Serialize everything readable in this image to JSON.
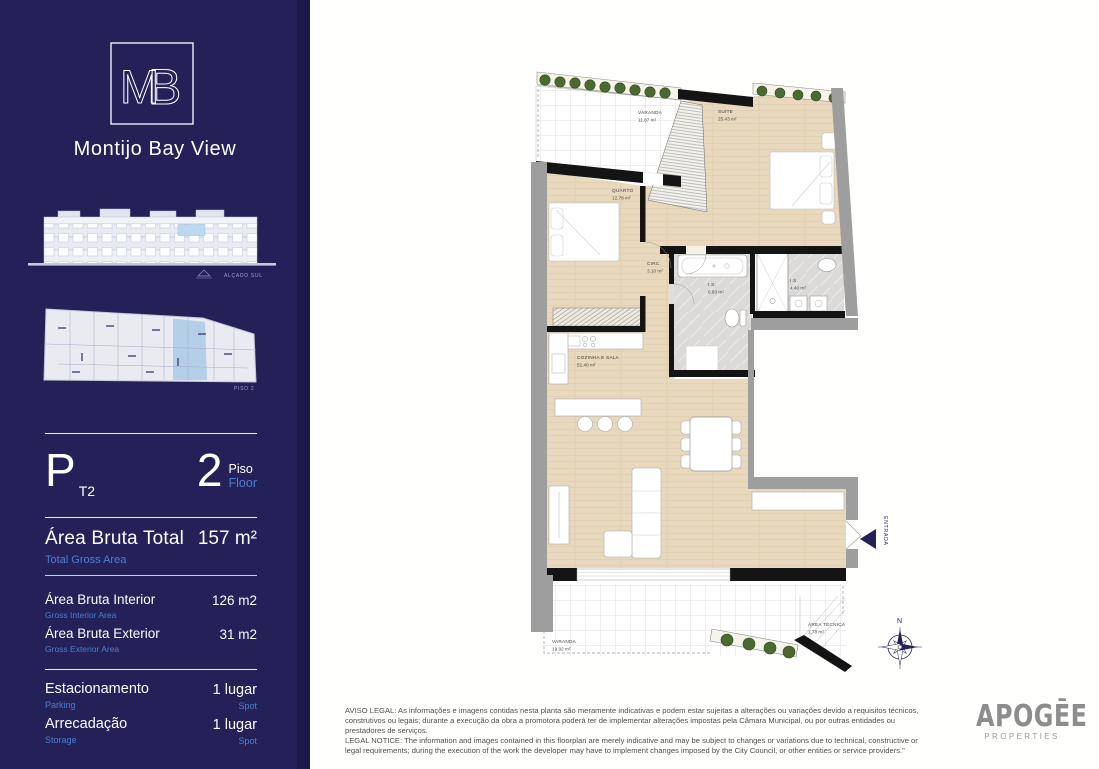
{
  "theme": {
    "navy": "#232158",
    "accent_blue": "#4d7fd2",
    "wall_gray": "#9e9e9e",
    "wood": "#e8d8bd",
    "highlight_blue": "#b5cfe9",
    "plant_green": "#4b6a2f"
  },
  "sidebar": {
    "logo": {
      "m": "M",
      "b": "B"
    },
    "project_name": "Montijo Bay View",
    "elevation_caption": "ALÇADO SUL",
    "keyplan_caption": "PISO 2",
    "unit": {
      "type_letter": "P",
      "typology": "T2",
      "floor_number": "2",
      "floor_label_pt": "Piso",
      "floor_label_en": "Floor"
    },
    "areas": {
      "total": {
        "label_pt": "Área Bruta Total",
        "label_en": "Total Gross Area",
        "value": "157 m²"
      },
      "rows": [
        {
          "label_pt": "Área Bruta Interior",
          "label_en": "Gross Interior Area",
          "value": "126 m2"
        },
        {
          "label_pt": "Área Bruta Exterior",
          "label_en": "Gross Exterior Area",
          "value": "31 m2"
        }
      ]
    },
    "amenities": [
      {
        "label_pt": "Estacionamento",
        "label_en": "Parking",
        "value": "1 lugar",
        "value_en": "Spot"
      },
      {
        "label_pt": "Arrecadação",
        "label_en": "Storage",
        "value": "1 lugar",
        "value_en": "Spot"
      }
    ]
  },
  "floorplan": {
    "rooms": [
      {
        "name": "VARANDA",
        "area": "11.87 m²"
      },
      {
        "name": "SUITE",
        "area": "25.43 m²"
      },
      {
        "name": "QUARTO",
        "area": "12.78 m²"
      },
      {
        "name": "CIRC.",
        "area": "3.10 m²"
      },
      {
        "name": "I.S.",
        "area": "6.83 m²"
      },
      {
        "name": "I.S.",
        "area": "4.40 m²"
      },
      {
        "name": "COZINHA E SALA",
        "area": "51.40 m²"
      },
      {
        "name": "VARANDA",
        "area": "19.92 m²"
      },
      {
        "name": "ÁREA TÉCNICA",
        "area": "1.78 m²"
      }
    ],
    "entrance_label": "ENTRADA",
    "compass_label": "N"
  },
  "footer": {
    "legal_pt": "AVISO LEGAL: As informações e imagens contidas nesta planta são meramente indicativas e podem estar sujeitas a alterações ou variações devido a requisitos técnicos, construtivos ou legais; durante a execução da obra a promotora poderá ter de implementar alterações impostas pela Câmara Municipal, ou por outras entidades ou prestadores de serviços.",
    "legal_en": "LEGAL NOTICE: The information and images contained in this floorplan are merely indicative and may be subject to changes or variations due to technical, constructive or legal requirements; during the execution of the work the developer may have to implement changes imposed by the City Council, or other entities or service providers.\"",
    "brand_name": "APOGĒE",
    "brand_sub": "PROPERTIES"
  }
}
